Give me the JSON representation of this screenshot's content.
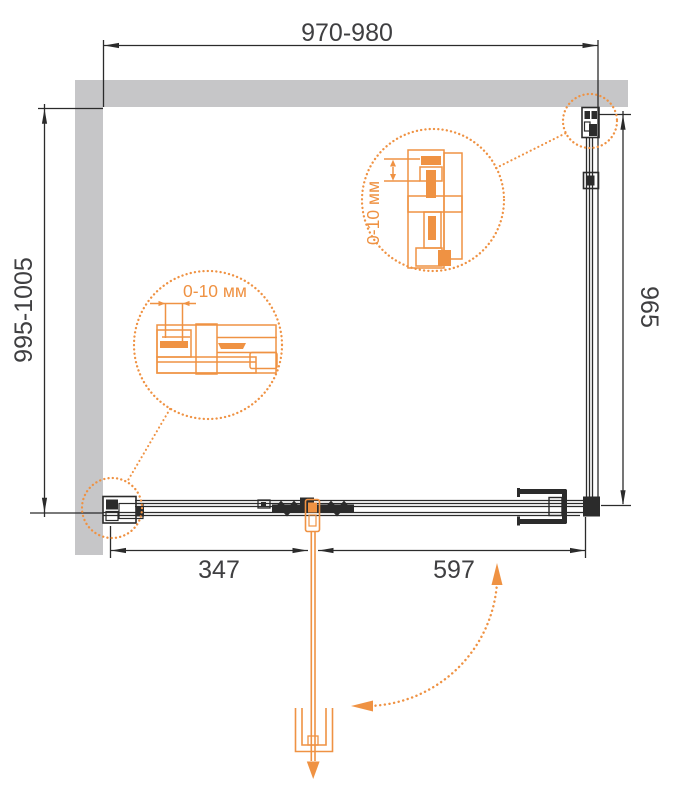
{
  "title": "Shower enclosure plan drawing",
  "colors": {
    "accent": "#EF9243",
    "line": "#2b2b2b",
    "wall": "#c6c6c8",
    "dim_text": "#3f3f41"
  },
  "dimensions": {
    "top_width": "970-980",
    "left_height": "995-1005",
    "right_height": "965",
    "bottom_left_width": "347",
    "bottom_right_width": "597"
  },
  "details": {
    "top_adjustment": "0-10 мм",
    "bottom_adjustment": "0-10 мм"
  }
}
